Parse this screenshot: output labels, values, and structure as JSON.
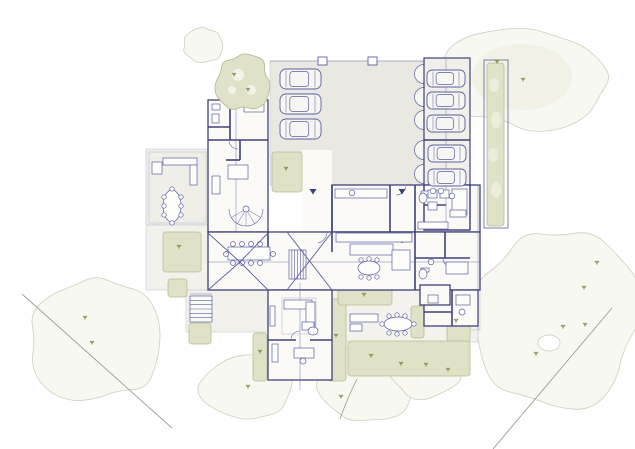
{
  "meta": {
    "drawing_type": "architectural-site-floor-plan",
    "canvas": {
      "w": 635,
      "h": 449
    }
  },
  "palette": {
    "ink": "#5c5ea3",
    "wall": "#3f417b",
    "lineLight": "#c7c7d8",
    "floor": "#fbfaf6",
    "olive": "#dfe2c7",
    "oliveStroke": "#b8bd92",
    "oliveDark": "#7d8a49",
    "faint": "#cdc9b5",
    "faintFill": "#f8f8f1",
    "faintTint": "#eff0e1",
    "boundary": "#a29b8d",
    "white": "#f7f7f1"
  },
  "counts": {
    "cars": 8,
    "entrance_arrows": 2
  },
  "scene": {
    "canopies": [
      {
        "cx": 527,
        "cy": 77,
        "rx": 83,
        "ry": 50,
        "seed": 7,
        "tint": true
      },
      {
        "cx": 557,
        "cy": 320,
        "rx": 82,
        "ry": 88,
        "seed": 11
      },
      {
        "cx": 96,
        "cy": 340,
        "rx": 64,
        "ry": 62,
        "seed": 3
      },
      {
        "cx": 246,
        "cy": 387,
        "rx": 45,
        "ry": 32,
        "seed": 5
      },
      {
        "cx": 369,
        "cy": 384,
        "rx": 49,
        "ry": 39,
        "seed": 9
      },
      {
        "cx": 425,
        "cy": 369,
        "rx": 35,
        "ry": 29,
        "seed": 13
      },
      {
        "cx": 203,
        "cy": 45,
        "rx": 20,
        "ry": 18,
        "seed": 4
      }
    ],
    "tint": {
      "cx": 522,
      "cy": 77,
      "rx": 50,
      "ry": 33
    },
    "holes": [
      {
        "cx": 549,
        "cy": 343,
        "rx": 11,
        "ry": 8
      }
    ],
    "boundaries": [
      [
        22,
        294,
        172,
        428
      ],
      [
        612,
        308,
        493,
        449
      ]
    ],
    "branch": "M340,419 C346,402 350,393 357,379",
    "paving": [
      {
        "x": 270,
        "y": 61,
        "w": 155,
        "h": 124,
        "f": "#e9e8e1"
      },
      {
        "x": 424,
        "y": 58,
        "w": 46,
        "h": 172,
        "f": "#f0efe9"
      },
      {
        "x": 146,
        "y": 149,
        "w": 62,
        "h": 76,
        "f": "#efeee7"
      },
      {
        "x": 146,
        "y": 225,
        "w": 62,
        "h": 65,
        "f": "#f2f1eb"
      },
      {
        "x": 186,
        "y": 290,
        "w": 82,
        "h": 42,
        "f": "#f1f0ea"
      },
      {
        "x": 332,
        "y": 290,
        "w": 146,
        "h": 52,
        "f": "#f3f2ec"
      },
      {
        "x": 470,
        "y": 185,
        "w": 10,
        "h": 145,
        "f": "#f1f0ea"
      }
    ],
    "white_rects": [
      {
        "x": 302,
        "y": 150,
        "w": 30,
        "h": 82
      }
    ],
    "scallops": [
      74,
      97,
      120,
      150,
      174
    ],
    "hedges": [
      {
        "x": 487,
        "y": 63,
        "w": 17,
        "h": 163
      },
      {
        "x": 272,
        "y": 152,
        "w": 30,
        "h": 40
      },
      {
        "x": 163,
        "y": 232,
        "w": 38,
        "h": 40
      },
      {
        "x": 168,
        "y": 279,
        "w": 19,
        "h": 18
      },
      {
        "x": 189,
        "y": 323,
        "w": 22,
        "h": 21
      },
      {
        "x": 253,
        "y": 333,
        "w": 14,
        "h": 48
      },
      {
        "x": 328,
        "y": 299,
        "w": 18,
        "h": 82
      },
      {
        "x": 338,
        "y": 288,
        "w": 54,
        "h": 17
      },
      {
        "x": 447,
        "y": 305,
        "w": 23,
        "h": 37
      },
      {
        "x": 348,
        "y": 341,
        "w": 122,
        "h": 35
      },
      {
        "x": 411,
        "y": 306,
        "w": 13,
        "h": 32
      }
    ],
    "hedge_border": {
      "x": 484,
      "y": 60,
      "w": 24,
      "h": 168
    },
    "hedge_patches": [
      {
        "cx": 494,
        "cy": 85,
        "rx": 5,
        "ry": 7
      },
      {
        "cx": 496,
        "cy": 120,
        "rx": 5,
        "ry": 8
      },
      {
        "cx": 493,
        "cy": 155,
        "rx": 5,
        "ry": 7
      },
      {
        "cx": 496,
        "cy": 190,
        "rx": 5,
        "ry": 8
      }
    ],
    "wings": [
      {
        "x": 208,
        "y": 100,
        "w": 60,
        "h": 132
      },
      {
        "x": 332,
        "y": 185,
        "w": 148,
        "h": 47
      },
      {
        "x": 208,
        "y": 232,
        "w": 272,
        "h": 58
      },
      {
        "x": 268,
        "y": 290,
        "w": 64,
        "h": 90
      },
      {
        "x": 424,
        "y": 185,
        "w": 46,
        "h": 45
      },
      {
        "x": 424,
        "y": 290,
        "w": 54,
        "h": 36
      },
      {
        "x": 420,
        "y": 285,
        "w": 30,
        "h": 20
      }
    ],
    "outlines": [
      {
        "x": 424,
        "y": 58,
        "w": 46,
        "h": 172
      }
    ],
    "walls": [
      [
        230,
        100,
        230,
        140
      ],
      [
        208,
        127,
        230,
        127
      ],
      [
        208,
        140,
        268,
        140
      ],
      [
        240,
        140,
        240,
        160
      ],
      [
        226,
        160,
        240,
        160
      ],
      [
        332,
        185,
        332,
        232
      ],
      [
        390,
        185,
        390,
        232
      ],
      [
        415,
        185,
        415,
        290
      ],
      [
        415,
        258,
        470,
        258
      ],
      [
        445,
        232,
        445,
        258
      ],
      [
        268,
        340,
        296,
        340
      ],
      [
        310,
        340,
        332,
        340
      ],
      [
        424,
        140,
        470,
        140
      ],
      [
        452,
        290,
        452,
        326
      ],
      [
        424,
        312,
        452,
        312
      ],
      [
        268,
        232,
        268,
        252
      ],
      [
        332,
        232,
        332,
        252
      ],
      [
        424,
        205,
        446,
        205
      ]
    ],
    "thin": [
      [
        270,
        61,
        425,
        61
      ],
      [
        478,
        185,
        478,
        330
      ],
      [
        300,
        283,
        300,
        390
      ],
      [
        446,
        58,
        446,
        230
      ],
      [
        236,
        100,
        236,
        232
      ],
      [
        208,
        262,
        480,
        262
      ],
      [
        246,
        209,
        260.7,
        217.5
      ],
      [
        246,
        209,
        254.5,
        223.7
      ],
      [
        246,
        209,
        246,
        226
      ],
      [
        246,
        209,
        237.5,
        223.7
      ],
      [
        246,
        209,
        231.3,
        217.5
      ],
      [
        190,
        294,
        212,
        294
      ]
    ],
    "lrects": [
      {
        "x": 282,
        "y": 298,
        "w": 34,
        "h": 36
      },
      {
        "x": 149,
        "y": 152,
        "w": 57,
        "h": 71
      }
    ],
    "arcs": [
      {
        "cx": 246,
        "cy": 209,
        "r": 17,
        "a1": 0,
        "a2": 180
      },
      {
        "cx": 316,
        "cy": 232,
        "r": 11,
        "a1": 0,
        "a2": 80
      },
      {
        "cx": 405,
        "cy": 232,
        "r": 11,
        "a1": 100,
        "a2": 180
      },
      {
        "cx": 396,
        "cy": 185,
        "r": 10,
        "a1": 10,
        "a2": 90
      },
      {
        "cx": 238,
        "cy": 140,
        "r": 9,
        "a1": 90,
        "a2": 170
      },
      {
        "cx": 300,
        "cy": 340,
        "r": 9,
        "a1": 190,
        "a2": 270
      },
      {
        "cx": 452,
        "cy": 258,
        "r": 9,
        "a1": 95,
        "a2": 175
      }
    ],
    "frects": [
      {
        "x": 212,
        "y": 104,
        "w": 8,
        "h": 6
      },
      {
        "x": 212,
        "y": 114,
        "w": 7,
        "h": 9
      },
      {
        "x": 244,
        "y": 104,
        "w": 20,
        "h": 8
      },
      {
        "x": 228,
        "y": 165,
        "w": 20,
        "h": 14
      },
      {
        "x": 212,
        "y": 176,
        "w": 8,
        "h": 18
      },
      {
        "x": 163,
        "y": 158,
        "w": 34,
        "h": 7
      },
      {
        "x": 190,
        "y": 165,
        "w": 7,
        "h": 20
      },
      {
        "x": 152,
        "y": 162,
        "w": 10,
        "h": 12
      },
      {
        "x": 228,
        "y": 247,
        "w": 42,
        "h": 13
      },
      {
        "x": 336,
        "y": 233,
        "w": 76,
        "h": 9
      },
      {
        "x": 350,
        "y": 244,
        "w": 43,
        "h": 11
      },
      {
        "x": 392,
        "y": 250,
        "w": 18,
        "h": 20
      },
      {
        "x": 335,
        "y": 189,
        "w": 52,
        "h": 9
      },
      {
        "x": 452,
        "y": 189,
        "w": 15,
        "h": 26
      },
      {
        "x": 421,
        "y": 191,
        "w": 8,
        "h": 4
      },
      {
        "x": 418,
        "y": 222,
        "w": 30,
        "h": 7
      },
      {
        "x": 446,
        "y": 262,
        "w": 22,
        "h": 12
      },
      {
        "x": 421,
        "y": 268,
        "w": 8,
        "h": 4
      },
      {
        "x": 428,
        "y": 190,
        "w": 9,
        "h": 8
      },
      {
        "x": 428,
        "y": 202,
        "w": 9,
        "h": 8
      },
      {
        "x": 440,
        "y": 190,
        "w": 9,
        "h": 8
      },
      {
        "x": 450,
        "y": 210,
        "w": 16,
        "h": 7
      },
      {
        "x": 428,
        "y": 295,
        "w": 10,
        "h": 8
      },
      {
        "x": 456,
        "y": 295,
        "w": 14,
        "h": 10
      },
      {
        "x": 284,
        "y": 300,
        "w": 28,
        "h": 9
      },
      {
        "x": 306,
        "y": 302,
        "w": 9,
        "h": 24
      },
      {
        "x": 270,
        "y": 306,
        "w": 5,
        "h": 20
      },
      {
        "x": 302,
        "y": 322,
        "w": 12,
        "h": 8
      },
      {
        "x": 294,
        "y": 348,
        "w": 20,
        "h": 10
      },
      {
        "x": 272,
        "y": 344,
        "w": 6,
        "h": 18
      },
      {
        "x": 350,
        "y": 314,
        "w": 28,
        "h": 8
      },
      {
        "x": 350,
        "y": 324,
        "w": 12,
        "h": 7
      }
    ],
    "fellipses": [
      {
        "cx": 172,
        "cy": 206,
        "rx": 9,
        "ry": 16
      },
      {
        "cx": 369,
        "cy": 268,
        "rx": 11,
        "ry": 7
      },
      {
        "cx": 398,
        "cy": 324,
        "rx": 14,
        "ry": 7
      },
      {
        "cx": 423,
        "cy": 198,
        "rx": 4,
        "ry": 5
      },
      {
        "cx": 423,
        "cy": 274,
        "rx": 4,
        "ry": 5
      },
      {
        "cx": 313,
        "cy": 331,
        "rx": 5,
        "ry": 4
      }
    ],
    "fcircles": [
      {
        "x": 164,
        "y": 197,
        "r": 2.2
      },
      {
        "x": 164,
        "y": 206,
        "r": 2.2
      },
      {
        "x": 164,
        "y": 215,
        "r": 2.2
      },
      {
        "x": 181,
        "y": 197,
        "r": 2.2
      },
      {
        "x": 181,
        "y": 206,
        "r": 2.2
      },
      {
        "x": 181,
        "y": 215,
        "r": 2.2
      },
      {
        "x": 172,
        "y": 189,
        "r": 2.2
      },
      {
        "x": 172,
        "y": 223,
        "r": 2.2
      },
      {
        "x": 233,
        "y": 244,
        "r": 2.5
      },
      {
        "x": 242,
        "y": 244,
        "r": 2.5
      },
      {
        "x": 251,
        "y": 244,
        "r": 2.5
      },
      {
        "x": 260,
        "y": 244,
        "r": 2.5
      },
      {
        "x": 233,
        "y": 263,
        "r": 2.5
      },
      {
        "x": 242,
        "y": 263,
        "r": 2.5
      },
      {
        "x": 251,
        "y": 263,
        "r": 2.5
      },
      {
        "x": 260,
        "y": 263,
        "r": 2.5
      },
      {
        "x": 226,
        "y": 254,
        "r": 2.5
      },
      {
        "x": 273,
        "y": 254,
        "r": 2.5
      },
      {
        "x": 361,
        "y": 260,
        "r": 2.2
      },
      {
        "x": 369,
        "y": 259,
        "r": 2.2
      },
      {
        "x": 377,
        "y": 260,
        "r": 2.2
      },
      {
        "x": 361,
        "y": 277,
        "r": 2.2
      },
      {
        "x": 369,
        "y": 278,
        "r": 2.2
      },
      {
        "x": 377,
        "y": 277,
        "r": 2.2
      },
      {
        "x": 389,
        "y": 316,
        "r": 2.2
      },
      {
        "x": 397,
        "y": 315,
        "r": 2.2
      },
      {
        "x": 405,
        "y": 316,
        "r": 2.2
      },
      {
        "x": 389,
        "y": 333,
        "r": 2.2
      },
      {
        "x": 397,
        "y": 334,
        "r": 2.2
      },
      {
        "x": 405,
        "y": 333,
        "r": 2.2
      },
      {
        "x": 382,
        "y": 324,
        "r": 2.2
      },
      {
        "x": 414,
        "y": 324,
        "r": 2.2
      },
      {
        "x": 433,
        "y": 191,
        "r": 2.8
      },
      {
        "x": 441,
        "y": 191,
        "r": 2.8
      },
      {
        "x": 431,
        "y": 262,
        "r": 2.8
      },
      {
        "x": 352,
        "y": 193,
        "r": 2.8
      },
      {
        "x": 452,
        "y": 196,
        "r": 2.8
      },
      {
        "x": 303,
        "y": 361,
        "r": 3
      },
      {
        "x": 462,
        "y": 312,
        "r": 3
      },
      {
        "x": 246,
        "y": 209,
        "r": 3
      }
    ],
    "stairs": [
      {
        "x": 190,
        "y": 296,
        "w": 22,
        "h": 26,
        "n": 6,
        "dir": "h"
      },
      {
        "x": 289,
        "y": 250,
        "w": 17,
        "h": 29,
        "n": 6,
        "dir": "v"
      }
    ],
    "roof": [
      [
        208,
        233,
        240,
        262
      ],
      [
        268,
        233,
        240,
        262
      ],
      [
        240,
        262,
        208,
        290
      ],
      [
        240,
        262,
        268,
        290
      ],
      [
        287,
        232,
        332,
        290
      ],
      [
        332,
        232,
        287,
        290
      ]
    ],
    "cars": [
      {
        "x": 280,
        "y": 69,
        "w": 41,
        "h": 20
      },
      {
        "x": 280,
        "y": 94,
        "w": 41,
        "h": 20
      },
      {
        "x": 280,
        "y": 119,
        "w": 41,
        "h": 20
      },
      {
        "x": 427,
        "y": 70,
        "w": 38,
        "h": 17
      },
      {
        "x": 427,
        "y": 92,
        "w": 38,
        "h": 17
      },
      {
        "x": 427,
        "y": 115,
        "w": 38,
        "h": 17
      },
      {
        "x": 428,
        "y": 145,
        "w": 38,
        "h": 17
      },
      {
        "x": 428,
        "y": 169,
        "w": 38,
        "h": 17
      }
    ],
    "posts": [
      {
        "x": 318,
        "y": 57,
        "w": 9,
        "h": 8
      },
      {
        "x": 368,
        "y": 57,
        "w": 9,
        "h": 8
      }
    ],
    "trees": [
      {
        "cx": 243,
        "cy": 82,
        "r": 27,
        "seed": 2
      }
    ],
    "tree_patches": [
      {
        "cx": 238,
        "cy": 75,
        "r": 6
      },
      {
        "cx": 251,
        "cy": 90,
        "r": 5
      },
      {
        "cx": 232,
        "cy": 90,
        "r": 4
      }
    ],
    "sprigs": [
      [
        234,
        75
      ],
      [
        248,
        90
      ],
      [
        286,
        169
      ],
      [
        179,
        247
      ],
      [
        260,
        352
      ],
      [
        336,
        336
      ],
      [
        364,
        295
      ],
      [
        456,
        321
      ],
      [
        371,
        356
      ],
      [
        401,
        364
      ],
      [
        426,
        365
      ],
      [
        448,
        370
      ],
      [
        497,
        62
      ],
      [
        523,
        80
      ],
      [
        597,
        263
      ],
      [
        584,
        288
      ],
      [
        563,
        327
      ],
      [
        585,
        325
      ],
      [
        85,
        318
      ],
      [
        92,
        343
      ],
      [
        248,
        387
      ],
      [
        341,
        397
      ],
      [
        536,
        354
      ]
    ],
    "arrows": [
      [
        313,
        189
      ],
      [
        402,
        189
      ]
    ]
  }
}
